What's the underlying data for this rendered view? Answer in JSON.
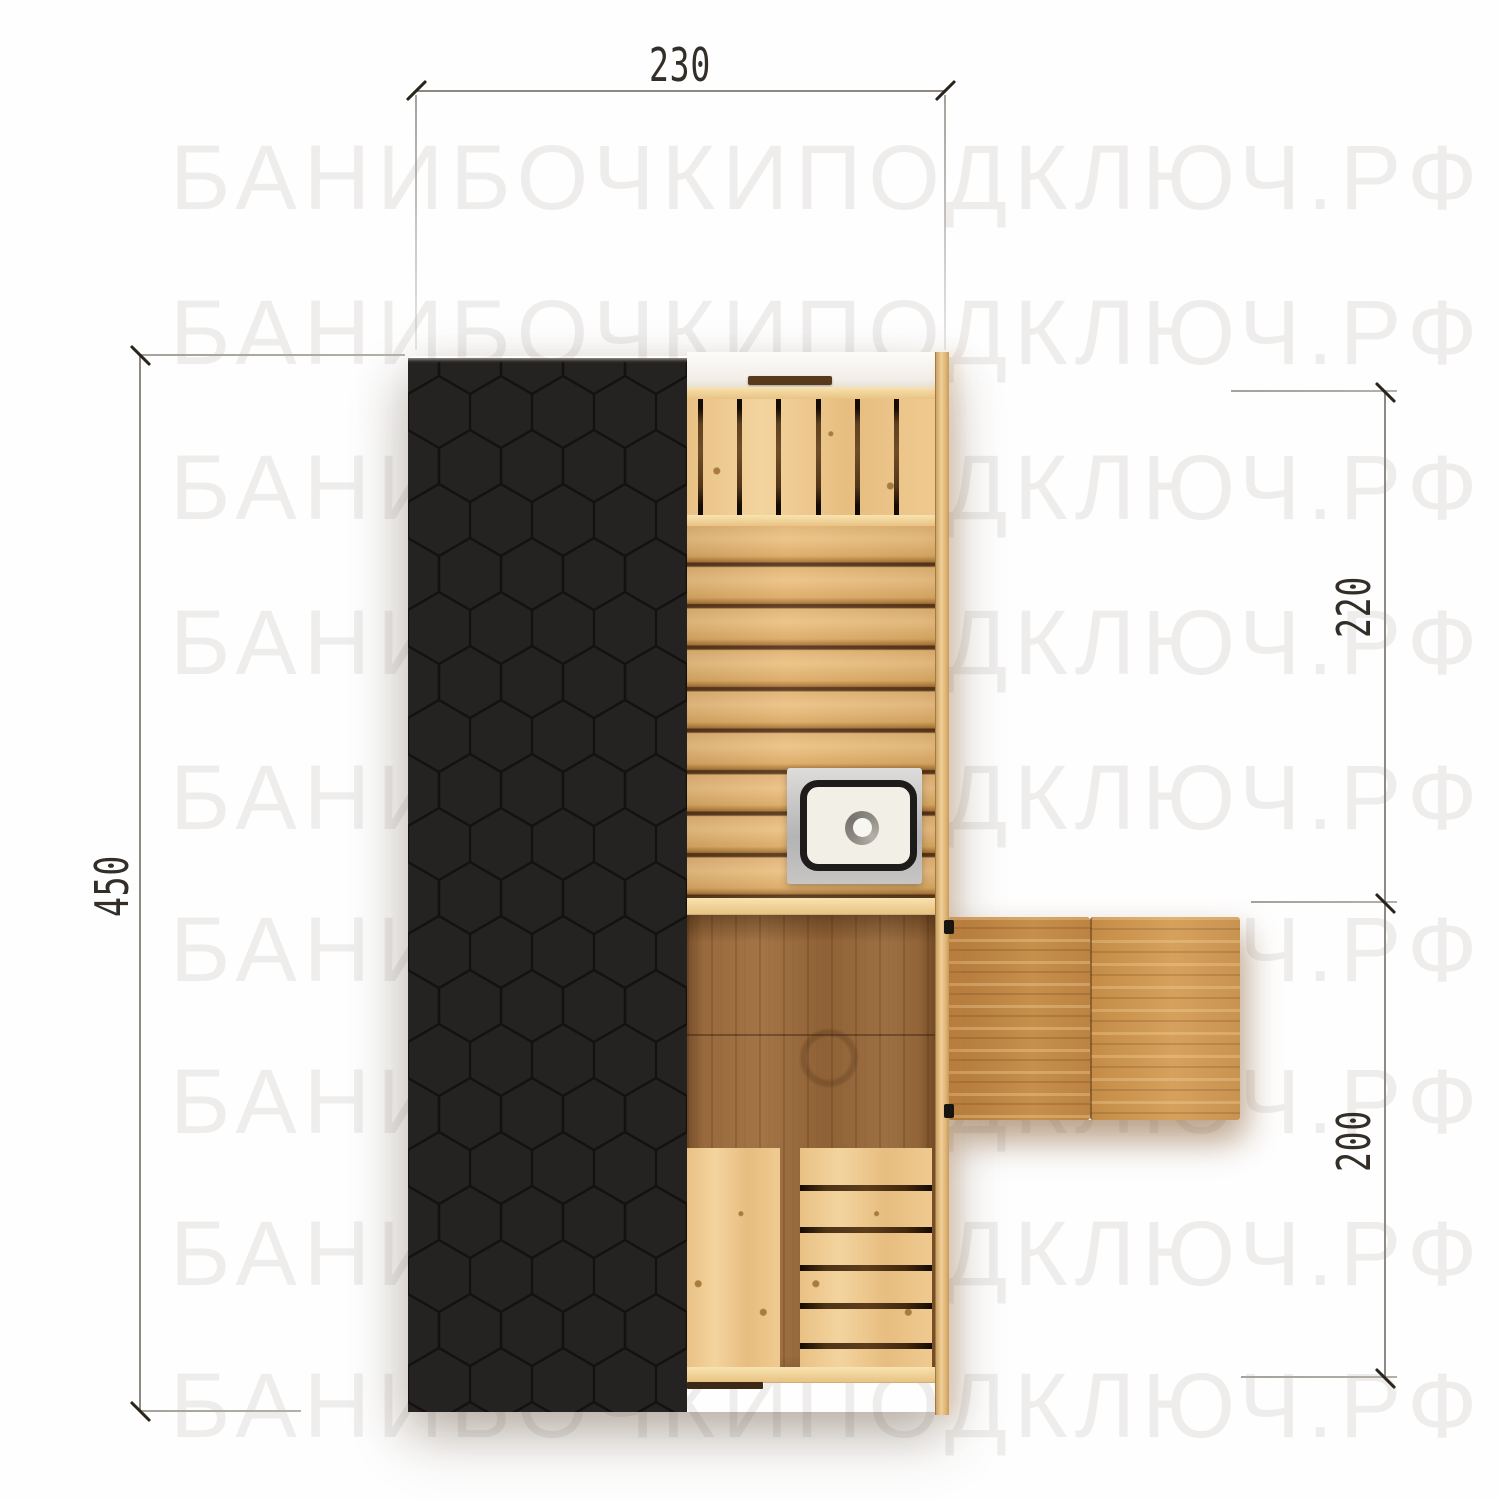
{
  "watermark": {
    "text": "БАНИБОЧКИПОДКЛЮЧ.РФ",
    "color": "#eeedec",
    "rows": 9
  },
  "dimensions": {
    "top_width": {
      "label": "230",
      "unit": "cm"
    },
    "left_height": {
      "label": "450",
      "unit": "cm"
    },
    "right_upper": {
      "label": "220",
      "unit": "cm"
    },
    "right_lower": {
      "label": "200",
      "unit": "cm"
    }
  },
  "palette": {
    "background": "#fefefe",
    "roof": "#252321",
    "roof_hex_outline": "#0f0d0b",
    "wood_light": "#edc68e",
    "wood_planks": "#dcaa64",
    "wood_floor_dark": "#9a6c3c",
    "deck_wood": "#c98f4b",
    "slat_gap": "#3a2611",
    "sink_frame": "#c3c2c0",
    "sink_rim": "#1d1c1a",
    "sink_basin": "#f2efe7",
    "dimension_line": "#8d8983",
    "dimension_text": "#332e28"
  }
}
